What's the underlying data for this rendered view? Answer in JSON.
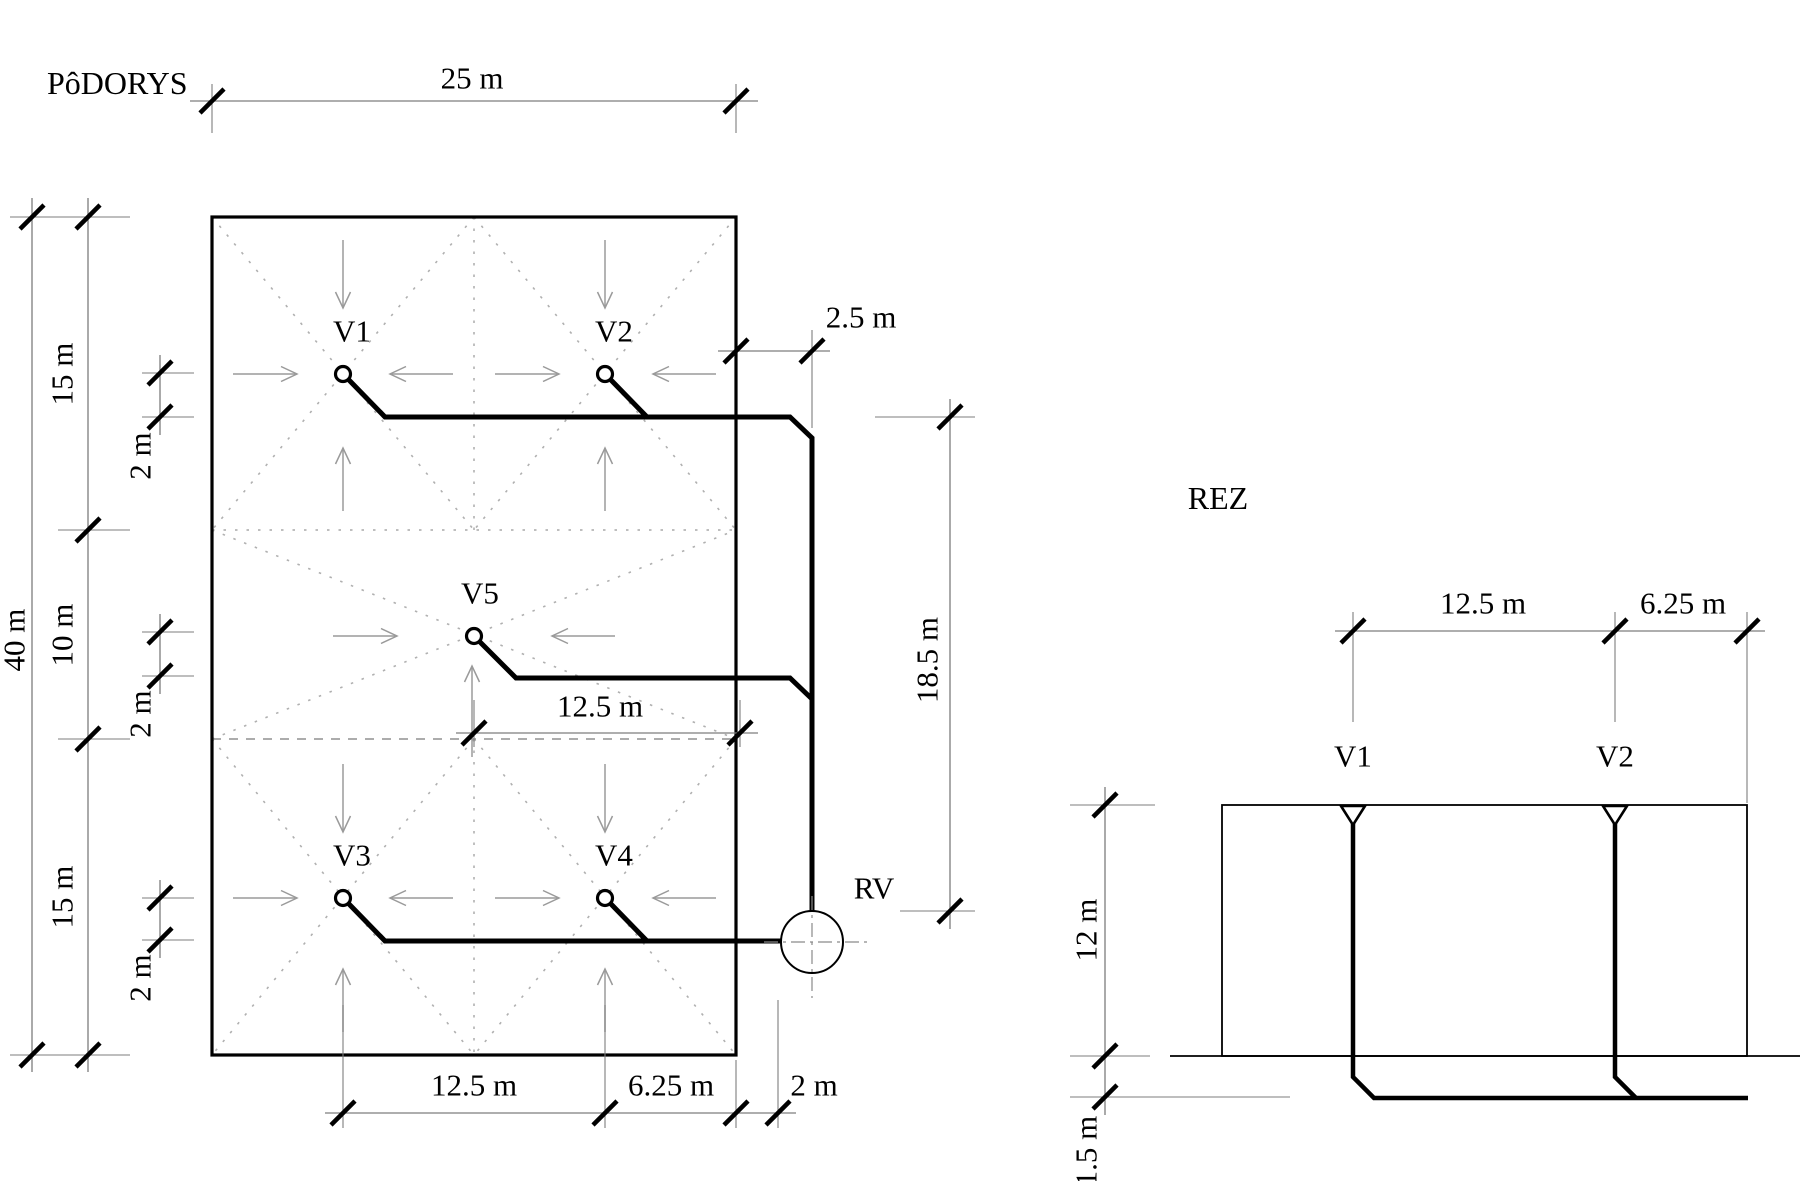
{
  "plan": {
    "title": "PôDORYS",
    "v1": "V1",
    "v2": "V2",
    "v3": "V3",
    "v4": "V4",
    "v5": "V5",
    "rv_label": "RV",
    "dim_top": "25 m",
    "dim_left_total": "40 m",
    "seg_top": "15 m",
    "seg_mid": "10 m",
    "seg_bot": "15 m",
    "off_1": "2 m",
    "off_2": "2 m",
    "off_3": "2 m",
    "dim_mid": "12.5 m",
    "dim_bottom_1": "12.5 m",
    "dim_bottom_2": "6.25 m",
    "dim_bottom_3": "2 m",
    "dim_right": "2.5 m",
    "dim_riser": "18.5 m"
  },
  "section": {
    "title": "REZ",
    "v1": "V1",
    "v2": "V2",
    "dim_1": "12.5 m",
    "dim_2": "6.25 m",
    "height": "12 m",
    "depth": "1.5 m"
  },
  "colors": {
    "ink": "#000000",
    "dim": "#7d7d7d",
    "arrow": "#9a9a9a",
    "dots": "#b0b0b0",
    "bg": "#ffffff"
  }
}
